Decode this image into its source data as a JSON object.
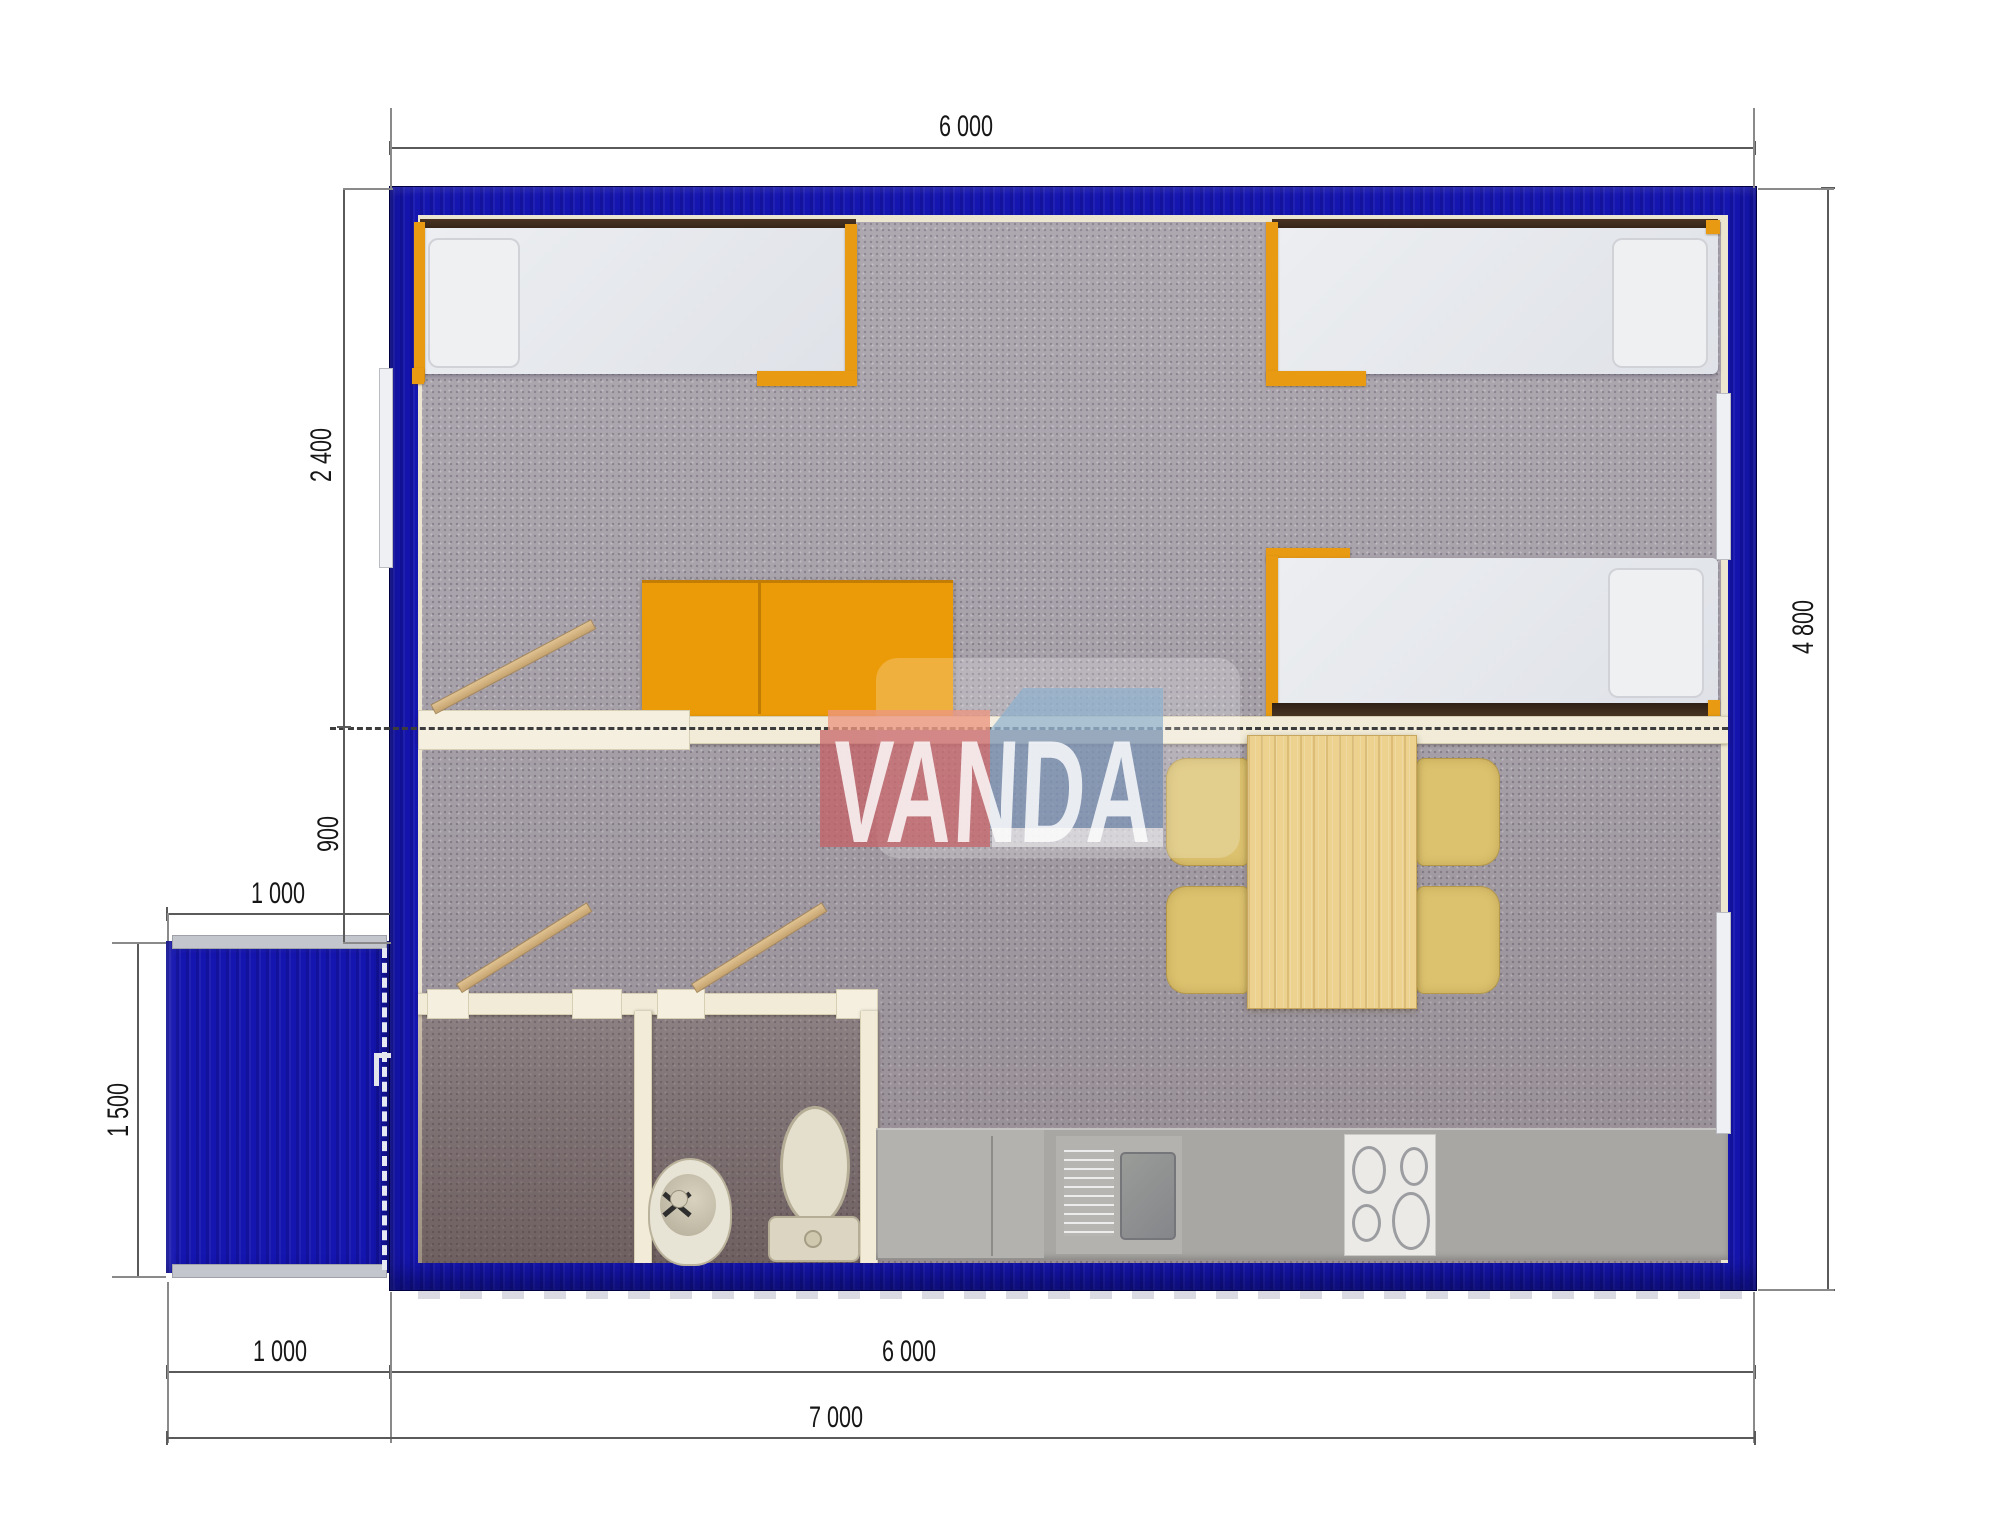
{
  "watermark": {
    "brand": "VANDA"
  },
  "dimensions": {
    "top_width": "6 000",
    "total_depth": "4 800",
    "bedroom_depth": "2 400",
    "hall_depth": "900",
    "porch_width_top": "1 000",
    "porch_depth": "1 500",
    "porch_width_bottom": "1 000",
    "bottom_width": "6 000",
    "total_width": "7 000"
  },
  "colors": {
    "wall_blue": "#1515b0",
    "accent_orange": "#ec9b08",
    "carpet_gray": "#a8a2ab",
    "interior_lining": "#ece5cf",
    "wood": "#ecd18f",
    "counter_gray": "#a9a7a4"
  }
}
